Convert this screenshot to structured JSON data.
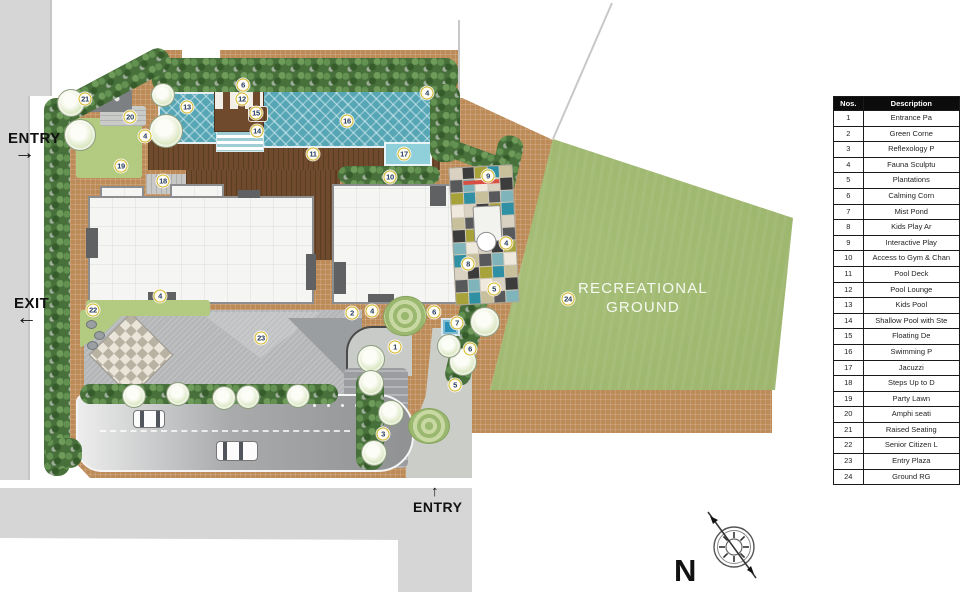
{
  "plan": {
    "labels": {
      "entry_left": "ENTRY",
      "exit_left": "EXIT",
      "entry_bottom": "ENTRY",
      "recreational_ground_line1": "RECREATIONAL",
      "recreational_ground_line2": "GROUND",
      "north_letter": "N"
    },
    "markers": [
      {
        "n": "21",
        "x": 85,
        "y": 99
      },
      {
        "n": "20",
        "x": 130,
        "y": 117
      },
      {
        "n": "6",
        "x": 243,
        "y": 85
      },
      {
        "n": "12",
        "x": 242,
        "y": 99
      },
      {
        "n": "13",
        "x": 187,
        "y": 107
      },
      {
        "n": "15",
        "x": 256,
        "y": 113
      },
      {
        "n": "14",
        "x": 257,
        "y": 131
      },
      {
        "n": "16",
        "x": 347,
        "y": 121
      },
      {
        "n": "4",
        "x": 427,
        "y": 93
      },
      {
        "n": "4",
        "x": 145,
        "y": 136
      },
      {
        "n": "19",
        "x": 121,
        "y": 166
      },
      {
        "n": "18",
        "x": 163,
        "y": 181
      },
      {
        "n": "11",
        "x": 313,
        "y": 154
      },
      {
        "n": "17",
        "x": 404,
        "y": 154
      },
      {
        "n": "10",
        "x": 390,
        "y": 177
      },
      {
        "n": "9",
        "x": 488,
        "y": 176
      },
      {
        "n": "4",
        "x": 506,
        "y": 243
      },
      {
        "n": "8",
        "x": 468,
        "y": 264
      },
      {
        "n": "5",
        "x": 494,
        "y": 289
      },
      {
        "n": "24",
        "x": 568,
        "y": 299
      },
      {
        "n": "22",
        "x": 93,
        "y": 310
      },
      {
        "n": "4",
        "x": 160,
        "y": 296
      },
      {
        "n": "2",
        "x": 352,
        "y": 313
      },
      {
        "n": "4",
        "x": 372,
        "y": 311
      },
      {
        "n": "6",
        "x": 434,
        "y": 312
      },
      {
        "n": "7",
        "x": 457,
        "y": 323
      },
      {
        "n": "1",
        "x": 395,
        "y": 347
      },
      {
        "n": "6",
        "x": 470,
        "y": 349
      },
      {
        "n": "5",
        "x": 455,
        "y": 385
      },
      {
        "n": "3",
        "x": 383,
        "y": 434
      },
      {
        "n": "23",
        "x": 261,
        "y": 338
      }
    ],
    "trees": [
      [
        70,
        102,
        13
      ],
      [
        79,
        134,
        15
      ],
      [
        165,
        130,
        16
      ],
      [
        162,
        94,
        11
      ],
      [
        133,
        395,
        11
      ],
      [
        177,
        393,
        11
      ],
      [
        223,
        397,
        11
      ],
      [
        247,
        396,
        11
      ],
      [
        297,
        395,
        11
      ],
      [
        370,
        358,
        13
      ],
      [
        370,
        382,
        12
      ],
      [
        462,
        361,
        13
      ],
      [
        373,
        452,
        12
      ],
      [
        484,
        321,
        14
      ],
      [
        448,
        345,
        11
      ],
      [
        390,
        412,
        12
      ]
    ],
    "play_tile_colors": [
      "#2f8fa3",
      "#a8a23b",
      "#3c3c3c",
      "#d9d2c2",
      "#efe9dd",
      "#7fb4ba",
      "#58595b",
      "#c8c09a"
    ],
    "colors": {
      "paving": "#bd8b57",
      "road": "#d6d6d6",
      "driveway_dark": "#8f9193",
      "pool": "#57a6b6",
      "jacuzzi": "#8fd0da",
      "wood_deck": "#6f4a2c",
      "hedge": "#47703a",
      "lawn": "#b3cb81",
      "recreational_green": "#9cb768",
      "building": "#f5f5f3",
      "marker_ring": "#d4b82a",
      "pond": "#2e8fb5"
    }
  },
  "legend_table": {
    "headers": {
      "nos": "Nos.",
      "description": "Description"
    },
    "rows": [
      {
        "no": "1",
        "description": "Entrance Pa"
      },
      {
        "no": "2",
        "description": "Green Corne"
      },
      {
        "no": "3",
        "description": "Reflexology P"
      },
      {
        "no": "4",
        "description": "Fauna Sculptu"
      },
      {
        "no": "5",
        "description": "Plantations"
      },
      {
        "no": "6",
        "description": "Calming Corn"
      },
      {
        "no": "7",
        "description": "Mist Pond"
      },
      {
        "no": "8",
        "description": "Kids Play Ar"
      },
      {
        "no": "9",
        "description": "Interactive Play"
      },
      {
        "no": "10",
        "description": "Access to Gym & Chan"
      },
      {
        "no": "11",
        "description": "Pool Deck"
      },
      {
        "no": "12",
        "description": "Pool Lounge"
      },
      {
        "no": "13",
        "description": "Kids Pool"
      },
      {
        "no": "14",
        "description": "Shallow Pool with Ste"
      },
      {
        "no": "15",
        "description": "Floating De"
      },
      {
        "no": "16",
        "description": "Swimming P"
      },
      {
        "no": "17",
        "description": "Jacuzzi"
      },
      {
        "no": "18",
        "description": "Steps Up to D"
      },
      {
        "no": "19",
        "description": "Party Lawn"
      },
      {
        "no": "20",
        "description": "Amphi seati"
      },
      {
        "no": "21",
        "description": "Raised Seating"
      },
      {
        "no": "22",
        "description": "Senior Citizen L"
      },
      {
        "no": "23",
        "description": "Entry Plaza"
      },
      {
        "no": "24",
        "description": "Ground RG"
      }
    ]
  }
}
